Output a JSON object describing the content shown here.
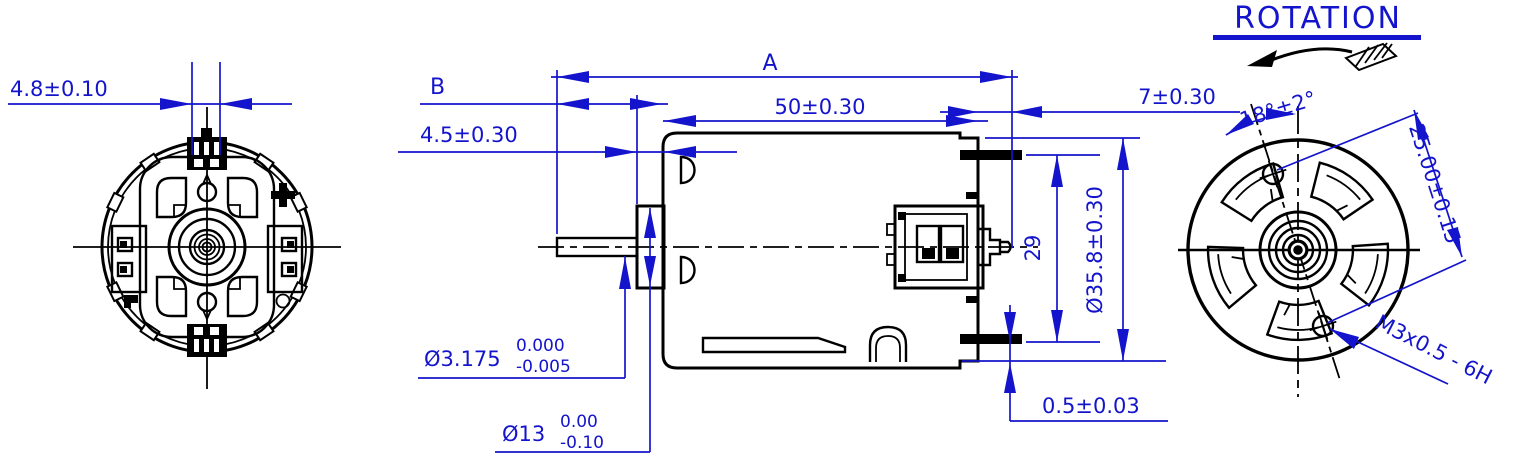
{
  "drawing": {
    "colors": {
      "accent": "#1414cc",
      "line": "#000000",
      "background": "#ffffff"
    },
    "rotation": {
      "label": "ROTATION"
    },
    "dimensions": {
      "terminal_width": "4.8±0.10",
      "overall_length": "A",
      "shaft_extension": "B",
      "case_length": "50±0.30",
      "collar_length": "4.5±0.30",
      "rear_boss_length": "7±0.30",
      "mount_hole_angle": "18°±2°",
      "mount_hole_spacing": "25.00±0.15",
      "terminal_span": "29",
      "case_diameter": "Ø35.8±0.30",
      "shaft_diameter": {
        "nominal": "Ø3.175",
        "upper": "0.000",
        "lower": "-0.005"
      },
      "collar_diameter": {
        "nominal": "Ø13",
        "upper": "0.00",
        "lower": "-0.10"
      },
      "endcap_step": "0.5±0.03",
      "mount_thread": "M3x0.5 - 6H"
    }
  }
}
